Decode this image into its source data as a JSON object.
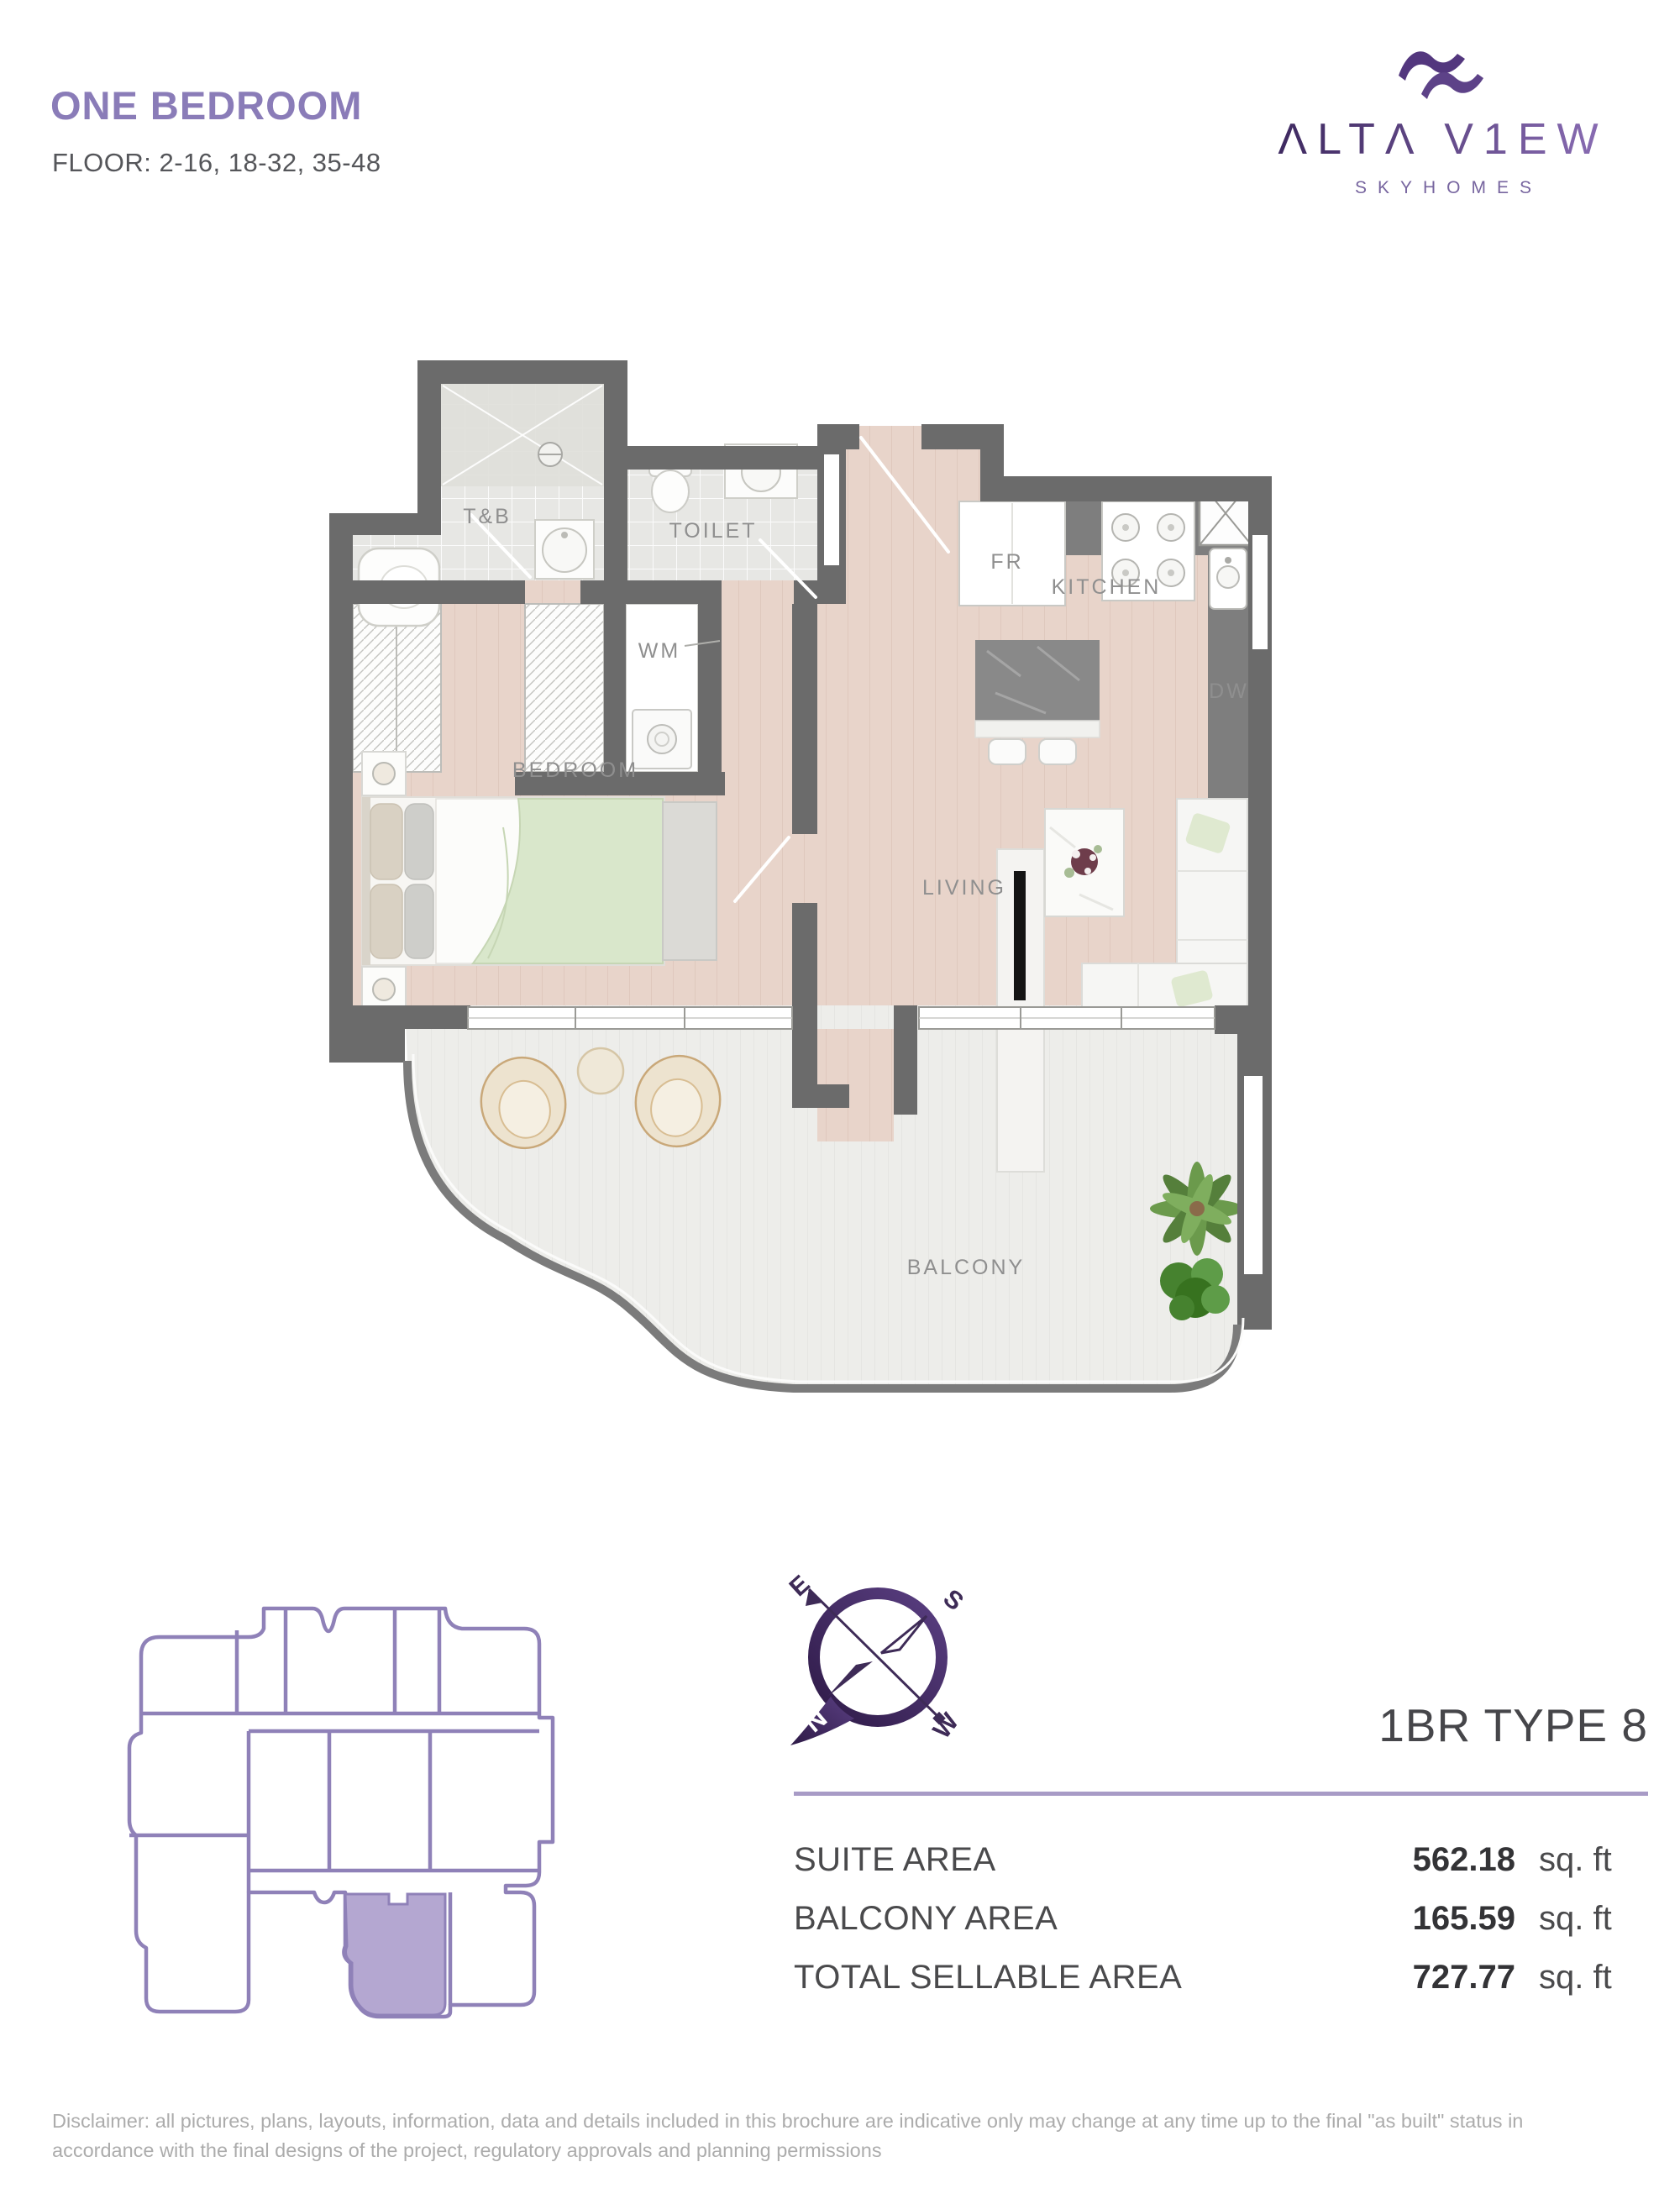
{
  "header": {
    "title": "ONE BEDROOM",
    "floors": "FLOOR: 2-16, 18-32, 35-48"
  },
  "brand": {
    "wordmark": "ΛLTΛ V1EW",
    "tagline": "SKYHOMES",
    "accent_dark": "#3E2960",
    "accent_light": "#8A6DB4"
  },
  "floor_plan": {
    "wall_color": "#6B6B6B",
    "labels": {
      "tb": "T&B",
      "toilet": "TOILET",
      "wm": "WM",
      "bedroom": "BEDROOM",
      "kitchen": "KITCHEN",
      "fridge": "FR",
      "dishwasher": "DW",
      "living": "LIVING",
      "balcony": "BALCONY"
    }
  },
  "compass": {
    "n": "N",
    "s": "S",
    "e": "E",
    "w": "W"
  },
  "key_plan": {
    "outline_color": "#8F81B8",
    "highlight_color": "#B4A7D1"
  },
  "unit": {
    "type_title": "1BR TYPE 8",
    "areas": [
      {
        "label": "SUITE AREA",
        "value": "562.18",
        "unit": "sq. ft"
      },
      {
        "label": "BALCONY AREA",
        "value": "165.59",
        "unit": "sq. ft"
      },
      {
        "label": "TOTAL SELLABLE AREA",
        "value": "727.77",
        "unit": "sq. ft"
      }
    ]
  },
  "disclaimer": {
    "text": "Disclaimer: all pictures, plans, layouts, information, data and details included in this brochure are indicative only may change at any time up to the final \"as built\" status in accordance with the final designs of the project, regulatory approvals and planning permissions"
  }
}
